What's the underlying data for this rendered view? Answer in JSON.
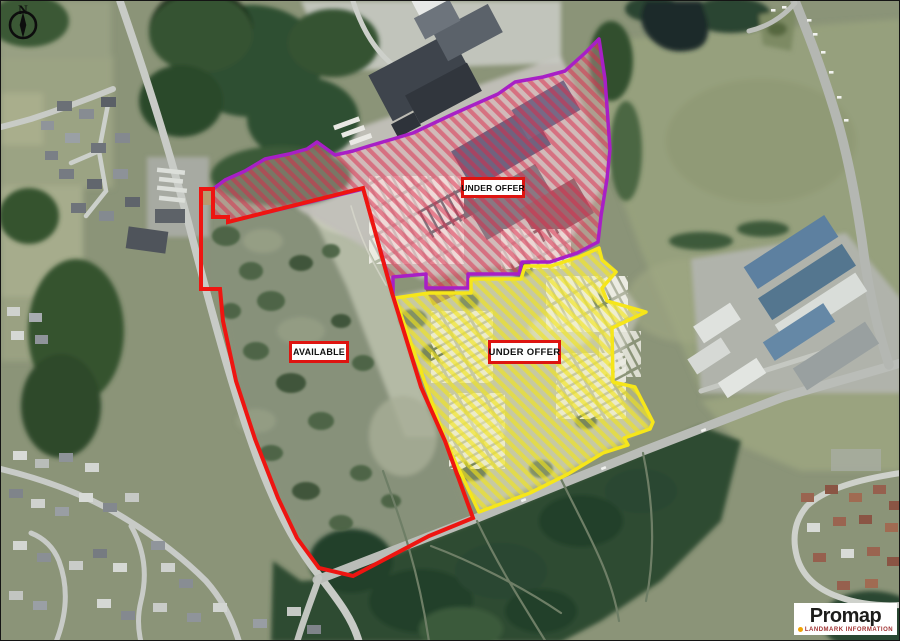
{
  "compass": {
    "label": "N"
  },
  "sites": [
    {
      "id": "north-site",
      "status": "UNDER OFFER",
      "outline_color": "#a81fc6",
      "hatch_color": "#dc2a49"
    },
    {
      "id": "west-site",
      "status": "AVAILABLE",
      "outline_color": "#ee1511",
      "hatch_color": null
    },
    {
      "id": "southeast-site",
      "status": "UNDER OFFER",
      "outline_color": "#f6e61a",
      "hatch_color": "#f0e41c"
    }
  ],
  "label_style": {
    "border_color": "#de1410",
    "background": "#ffffff",
    "text_color": "#101010"
  },
  "branding": {
    "name": "Promap",
    "tagline": "LANDMARK INFORMATION",
    "dot_color": "#f0a305"
  }
}
